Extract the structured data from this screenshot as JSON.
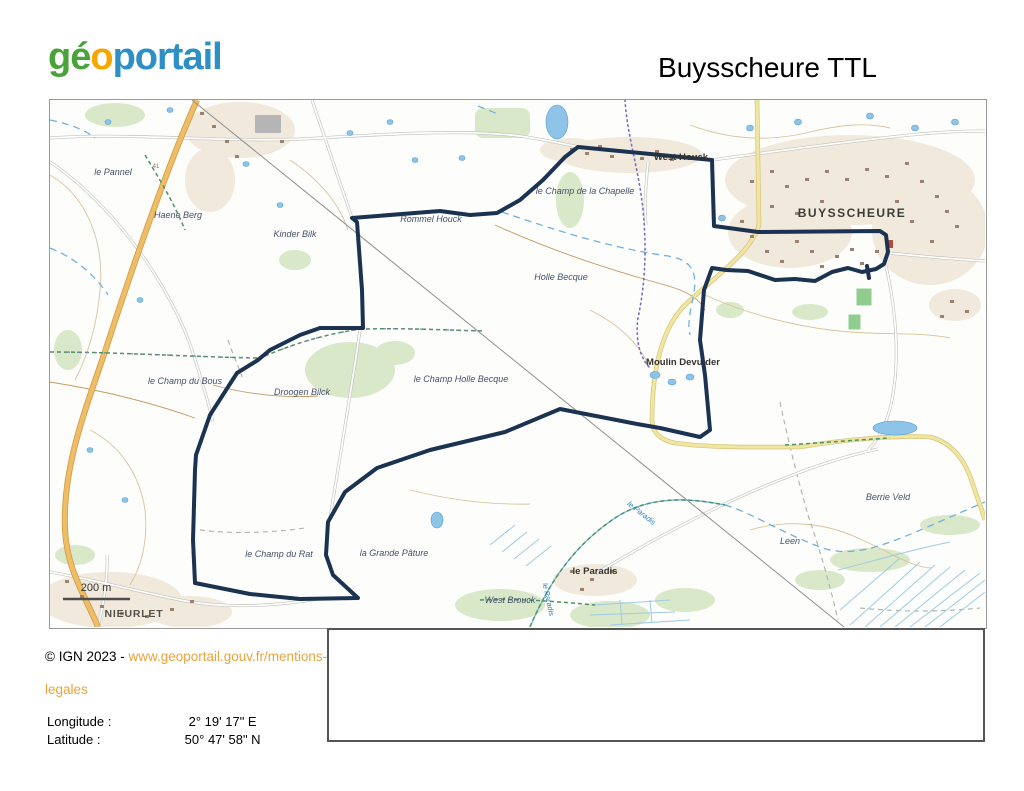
{
  "header": {
    "logo": {
      "part1": "gé",
      "part2": "o",
      "part3": "portail",
      "color_green": "#4aa23a",
      "color_orange": "#f7a600",
      "color_blue": "#2d8fc5"
    },
    "title": "Buysscheure TTL"
  },
  "map": {
    "track": {
      "color": "#1b3250",
      "points": "528,47 662,60 664,126 708,132 830,131 836,135 838,152 834,164 826,169 812,172 798,168 782,172 765,181 745,179 725,180 698,171 676,170 662,168 654,190 650,240 655,275 660,330 650,337 610,328 587,324 510,309 455,332 380,350 327,368 295,392 278,422 276,455 283,475 308,498 250,499 200,494 145,483 143,440 145,370 146,355 160,315 187,273 208,260 220,250 250,235 270,228 313,228 312,190 307,122 302,118 390,111 420,115 447,113 470,100 493,80 515,57 528,47",
      "spur_points": "817,166 819,178"
    },
    "labels": [
      {
        "text": "le Pannel",
        "x": 63,
        "y": 75,
        "cls": "lieu"
      },
      {
        "text": "Haene Berg",
        "x": 128,
        "y": 118,
        "cls": "lieu"
      },
      {
        "text": "Kinder Bilk",
        "x": 245,
        "y": 137,
        "cls": "lieu"
      },
      {
        "text": "Rommel Houck",
        "x": 381,
        "y": 122,
        "cls": "lieu"
      },
      {
        "text": "le Champ de la Chapelle",
        "x": 535,
        "y": 94,
        "cls": "lieu"
      },
      {
        "text": "West Houck",
        "x": 631,
        "y": 60,
        "cls": "place"
      },
      {
        "text": "BUYSSCHEURE",
        "x": 802,
        "y": 117,
        "cls": "village"
      },
      {
        "text": "Holle Becque",
        "x": 511,
        "y": 180,
        "cls": "lieu"
      },
      {
        "text": "Moulin Devulder",
        "x": 633,
        "y": 265,
        "cls": "place"
      },
      {
        "text": "le Champ du Bous",
        "x": 135,
        "y": 284,
        "cls": "lieu"
      },
      {
        "text": "Droogen Bilck",
        "x": 252,
        "y": 295,
        "cls": "lieu"
      },
      {
        "text": "le Champ Holle Becque",
        "x": 411,
        "y": 282,
        "cls": "lieu"
      },
      {
        "text": "Berrie Veld",
        "x": 838,
        "y": 400,
        "cls": "lieu"
      },
      {
        "text": "Leen",
        "x": 740,
        "y": 444,
        "cls": "lieu"
      },
      {
        "text": "le Champ du Rat",
        "x": 229,
        "y": 457,
        "cls": "lieu"
      },
      {
        "text": "la Grande Pâture",
        "x": 344,
        "y": 456,
        "cls": "lieu"
      },
      {
        "text": "le Paradis",
        "x": 545,
        "y": 474,
        "cls": "place"
      },
      {
        "text": "West Brouck",
        "x": 460,
        "y": 503,
        "cls": "lieu"
      },
      {
        "text": "NIEURLET",
        "x": 84,
        "y": 517,
        "cls": "village-small"
      },
      {
        "text": "le Paradis",
        "x": 590,
        "y": 415,
        "cls": "water",
        "rotate": 38
      },
      {
        "text": "le Paradis",
        "x": 496,
        "y": 500,
        "cls": "water",
        "rotate": 78
      },
      {
        "text": "41",
        "x": 106,
        "y": 68,
        "cls": "roadref"
      }
    ],
    "scale": {
      "label": "200 m"
    }
  },
  "footer": {
    "copyright_prefix": "© IGN 2023 - ",
    "link_line1": "www.geoportail.gouv.fr/mentions-",
    "link_line2": "legales",
    "link_color": "#e8a33d"
  },
  "coordinates": {
    "longitude_label": "Longitude :",
    "longitude_value": "2° 19' 17\" E",
    "latitude_label": "Latitude :",
    "latitude_value": "50° 47' 58\" N"
  }
}
